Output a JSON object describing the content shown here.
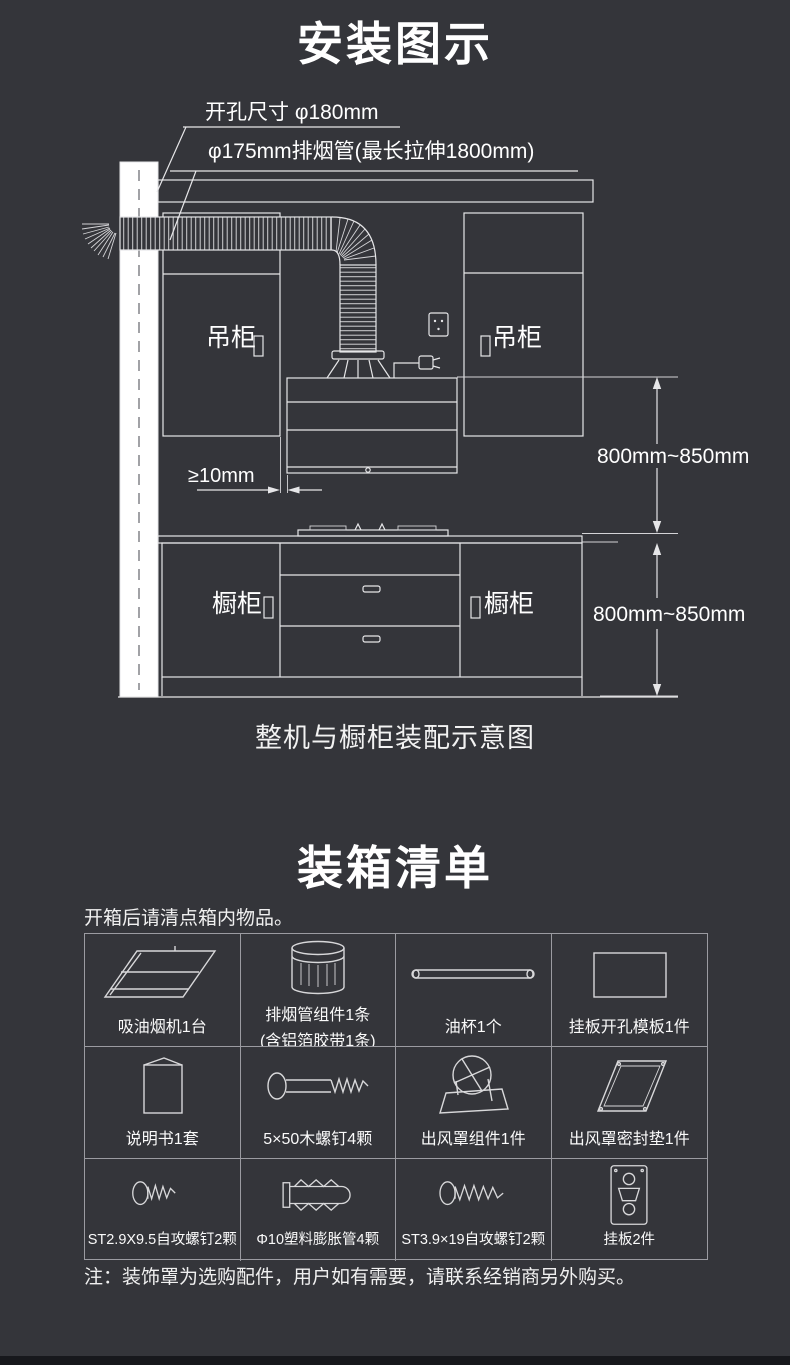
{
  "colors": {
    "background": "#34353a",
    "line": "#e6e6e8",
    "grid": "#9b9ba1",
    "wall_fill": "#f2f2f2",
    "text": "#ffffff",
    "bottom_bar": "#17181c"
  },
  "install": {
    "title": "安装图示",
    "caption": "整机与橱柜装配示意图",
    "hole_label": "开孔尺寸 φ180mm",
    "duct_label": "φ175mm排烟管(最长拉伸1800mm)",
    "clearance_label": "≥10mm",
    "dim_upper": "800mm~850mm",
    "dim_lower": "800mm~850mm",
    "cabinet_upper_left": "吊柜",
    "cabinet_upper_right": "吊柜",
    "cabinet_lower_left": "橱柜",
    "cabinet_lower_right": "橱柜"
  },
  "packing": {
    "title": "装箱清单",
    "intro": "开箱后请清点箱内物品。",
    "note": "注：装饰罩为选购配件，用户如有需要，请联系经销商另外购买。",
    "items": [
      {
        "label": "吸油烟机1台",
        "icon": "range-hood-icon"
      },
      {
        "label": "排烟管组件1条",
        "sublabel": "(含铝箔胶带1条)",
        "icon": "exhaust-duct-icon"
      },
      {
        "label": "油杯1个",
        "icon": "oil-cup-icon"
      },
      {
        "label": "挂板开孔模板1件",
        "icon": "drill-template-icon"
      },
      {
        "label": "说明书1套",
        "icon": "manual-icon"
      },
      {
        "label": "5×50木螺钉4颗",
        "icon": "wood-screw-icon"
      },
      {
        "label": "出风罩组件1件",
        "icon": "outlet-cover-icon"
      },
      {
        "label": "出风罩密封垫1件",
        "icon": "outlet-gasket-icon"
      },
      {
        "label": "ST2.9X9.5自攻螺钉2颗",
        "icon": "tapping-screw-small-icon"
      },
      {
        "label": "Φ10塑料膨胀管4颗",
        "icon": "expansion-anchor-icon"
      },
      {
        "label": "ST3.9×19自攻螺钉2颗",
        "icon": "tapping-screw-large-icon"
      },
      {
        "label": "挂板2件",
        "icon": "hanging-plate-icon"
      }
    ]
  }
}
